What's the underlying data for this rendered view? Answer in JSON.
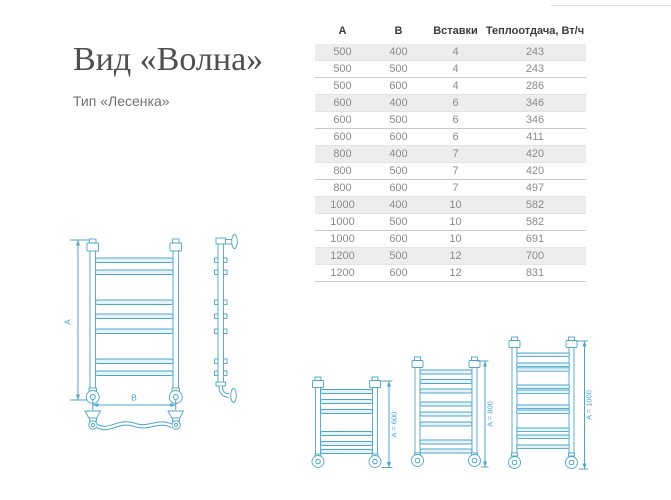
{
  "header": {
    "title": "Вид «Волна»",
    "subtitle": "Тип «Лесенка»"
  },
  "spec_table": {
    "columns": [
      "А",
      "В",
      "Вставки",
      "Теплоотдача, Вт/ч"
    ],
    "rows": [
      [
        "500",
        "400",
        "4",
        "243"
      ],
      [
        "500",
        "500",
        "4",
        "243"
      ],
      [
        "500",
        "600",
        "4",
        "286"
      ],
      [
        "600",
        "400",
        "6",
        "346"
      ],
      [
        "600",
        "500",
        "6",
        "346"
      ],
      [
        "600",
        "600",
        "6",
        "411"
      ],
      [
        "800",
        "400",
        "7",
        "420"
      ],
      [
        "800",
        "500",
        "7",
        "420"
      ],
      [
        "800",
        "600",
        "7",
        "497"
      ],
      [
        "1000",
        "400",
        "10",
        "582"
      ],
      [
        "1000",
        "500",
        "10",
        "582"
      ],
      [
        "1000",
        "600",
        "10",
        "691"
      ],
      [
        "1200",
        "500",
        "12",
        "700"
      ],
      [
        "1200",
        "600",
        "12",
        "831"
      ]
    ]
  },
  "drawings": {
    "front_view": {
      "dim_height_label": "А",
      "dim_width_label": "В"
    },
    "size_variants": [
      {
        "label": "A = 600"
      },
      {
        "label": "A = 800"
      },
      {
        "label": "A = 1000"
      }
    ]
  },
  "colors": {
    "drawing_stroke": "#4da6c9",
    "drawing_fill": "#e6f4f9",
    "table_stripe": "#ededed",
    "header_text": "#3d3d3d",
    "body_text": "#8c8c8c",
    "title_text": "#4f4f4f",
    "subtitle_text": "#707070"
  }
}
